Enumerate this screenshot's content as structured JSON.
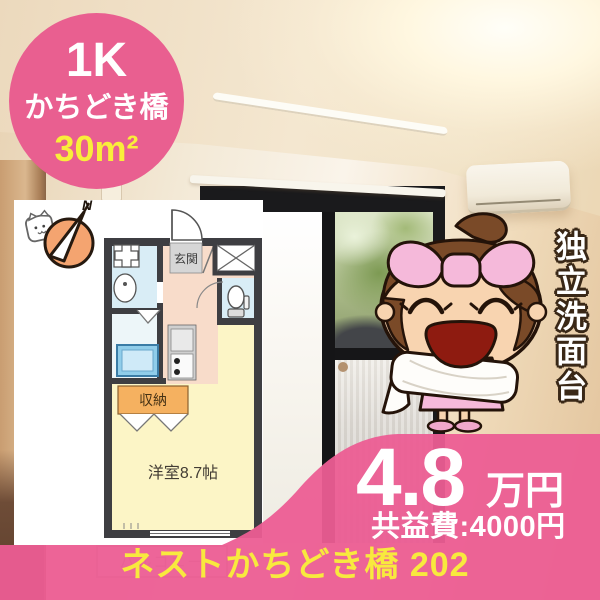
{
  "badge": {
    "layout": "1K",
    "location": "かちどき橋",
    "area": "30m²"
  },
  "floorplan": {
    "compass_n": "N",
    "entrance": "玄関",
    "closet": "収納",
    "main_room": "洋室8.7帖",
    "balcony": "バルコニー"
  },
  "feature": {
    "vertical_tag": "独立洗面台"
  },
  "price": {
    "amount": "4.8",
    "unit": "万円",
    "common_fee": "共益費:4000円"
  },
  "property": {
    "name": "ネストかちどき橋 202"
  },
  "colors": {
    "brand_pink": "#e95f90",
    "accent_yellow": "#f9ee3a",
    "compass_orange": "#f4a470"
  }
}
